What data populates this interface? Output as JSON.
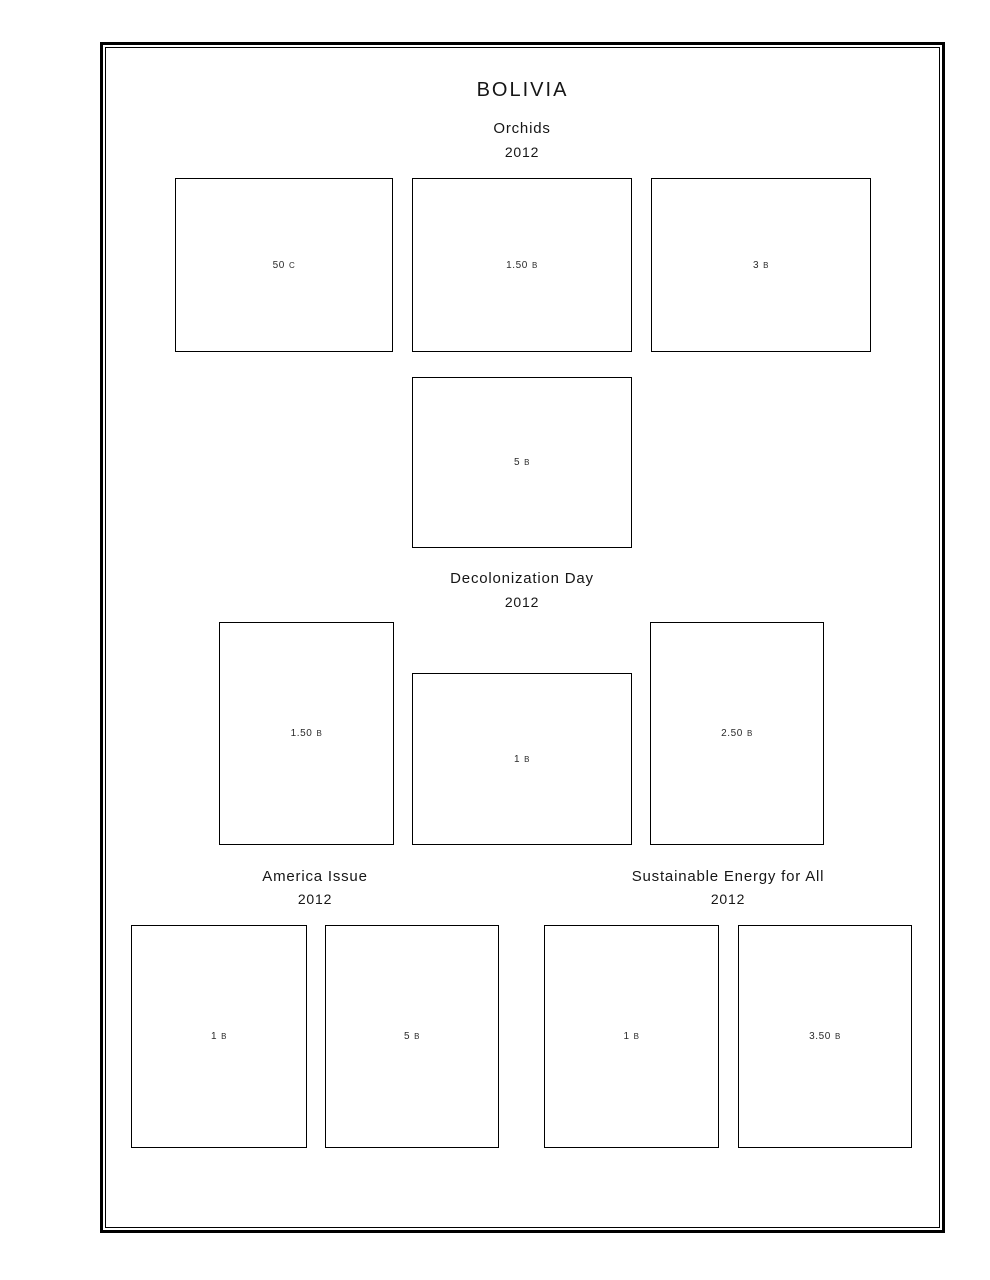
{
  "page": {
    "title": "BOLIVIA",
    "ink_color": "#161616",
    "paper_color": "#ffffff"
  },
  "sections": [
    {
      "title": "Orchids",
      "year": "2012",
      "stamps": [
        {
          "value": "50",
          "currency": "C"
        },
        {
          "value": "1.50",
          "currency": "B"
        },
        {
          "value": "3",
          "currency": "B"
        },
        {
          "value": "5",
          "currency": "B"
        }
      ]
    },
    {
      "title": "Decolonization Day",
      "year": "2012",
      "stamps": [
        {
          "value": "1.50",
          "currency": "B"
        },
        {
          "value": "1",
          "currency": "B"
        },
        {
          "value": "2.50",
          "currency": "B"
        }
      ]
    },
    {
      "title": "America Issue",
      "year": "2012",
      "stamps": [
        {
          "value": "1",
          "currency": "B"
        },
        {
          "value": "5",
          "currency": "B"
        }
      ]
    },
    {
      "title": "Sustainable Energy for All",
      "year": "2012",
      "stamps": [
        {
          "value": "1",
          "currency": "B"
        },
        {
          "value": "3.50",
          "currency": "B"
        }
      ]
    }
  ]
}
